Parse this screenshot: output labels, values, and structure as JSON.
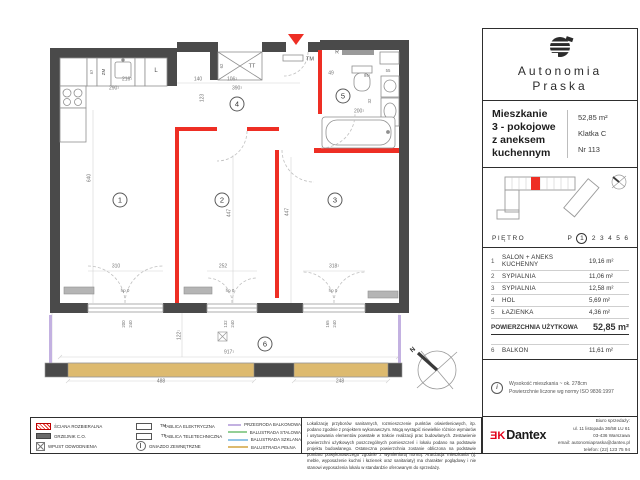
{
  "colors": {
    "wall": "#4a4a4a",
    "removable_wall_red": "#ee2e24",
    "balcony_partition_purple": "#c3b1e1",
    "balustrade_steel_green": "#93cf96",
    "balustrade_glass_blue": "#92c5e8",
    "balustrade_full_tan": "#ddba6f",
    "dantex_red": "#e2001a"
  },
  "panel": {
    "brand": {
      "name_line1": "Autonomia",
      "name_line2": "Praska"
    },
    "apartment": {
      "title_line1": "Mieszkanie",
      "title_line2": "3 - pokojowe",
      "title_line3": "z aneksem",
      "title_line4": "kuchennym",
      "area": "52,85 m²",
      "staircase": "Klatka C",
      "number": "Nr 113"
    },
    "floor_row": {
      "label": "PIĘTRO",
      "prefix": "P",
      "current": "1",
      "n2": "2",
      "n3": "3",
      "n4": "4",
      "n5": "5",
      "n6": "6"
    },
    "rooms": [
      {
        "num": "1",
        "name": "SALON + ANEKS KUCHENNY",
        "area": "19,16 m²"
      },
      {
        "num": "2",
        "name": "SYPIALNIA",
        "area": "11,06 m²"
      },
      {
        "num": "3",
        "name": "SYPIALNIA",
        "area": "12,58 m²"
      },
      {
        "num": "4",
        "name": "HOL",
        "area": "5,69 m²"
      },
      {
        "num": "5",
        "name": "ŁAZIENKA",
        "area": "4,36 m²"
      }
    ],
    "total": {
      "label": "POWIERZCHNIA UŻYTKOWA",
      "value": "52,85 m²"
    },
    "balcony_row": {
      "num": "6",
      "name": "BALKON",
      "area": "11,61 m²"
    },
    "note": {
      "icon": "i",
      "line1": "Wysokość mieszkania ~ ok. 278cm",
      "line2": "Powierzchnie liczone wg normy ISO 9836:1997"
    },
    "footer": {
      "logo_mark": "ƎK",
      "logo_text": "Dantex",
      "addr_line1": "Biuro sprzedaży:",
      "addr_line2": "ul. 11 listopada 36/58 LU 61",
      "addr_line3": "03-436 Warszawa",
      "addr_line4": "email: autonomiapraska@dantex.pl",
      "addr_line5": "telefon: (22) 123 75 94"
    }
  },
  "plan": {
    "rooms": {
      "r1": "1",
      "r2": "2",
      "r3": "3",
      "r4": "4",
      "r5": "5",
      "r6": "6"
    },
    "labels": {
      "tm": "TM",
      "tt": "TT",
      "zm": "ZM",
      "fridge": "L",
      "radiator_r": "R",
      "cab57": "57"
    },
    "dims": {
      "d216": "216¹",
      "d290": "290¹",
      "d140": "140",
      "d106": "106¹",
      "d390": "390¹",
      "d123": "123",
      "d640": "640",
      "d447a": "447",
      "d447b": "447",
      "d310": "310",
      "d252": "252",
      "d318": "318¹",
      "hp1": "hp 0",
      "hp2": "hp 0",
      "hp3": "hp 0",
      "d49": "49",
      "d94": "94¹",
      "d55": "55",
      "d200": "200¹",
      "d32": "32",
      "d62": "62",
      "b200": "200",
      "b240a": "240",
      "b132": "132",
      "b240b": "240",
      "b165": "165",
      "b240c": "240",
      "d122": "122¹",
      "d917": "917¹",
      "d488": "488",
      "d248": "248"
    },
    "compass_n": "N"
  },
  "legend": {
    "items": [
      {
        "label": "ŚCIANA ROZBIERALNA"
      },
      {
        "label": "GRZEJNIK C.O."
      },
      {
        "label": "WPUST ODWODNIENIA"
      },
      {
        "tag": "TM",
        "label": "TABLICA ELEKTRYCZNA"
      },
      {
        "tag": "TT",
        "label": "TABLICA TELETECHNICZNA"
      },
      {
        "label": "GNIAZDO ZEWNĘTRZNE"
      },
      {
        "color": "#c3b1e1",
        "label": "PRZEGRODA BALKONOWA"
      },
      {
        "color": "#93cf96",
        "label": "BALUSTRADA STALOWA"
      },
      {
        "color": "#92c5e8",
        "label": "BALUSTRADA SZKLANA"
      },
      {
        "color": "#ddba6f",
        "label": "BALUSTRADA PEŁNA"
      }
    ]
  },
  "disclaimer": "Lokalizację przyborów sanitarnych, rozmieszczenie punktów oświetleniowych, itp. podano zgodnie z projektem wykonawczym. Mogą wystąpić niewielkie różnice wymiarów i usytuowania elementów powstałe w trakcie realizacji prac budowlanych. Zestawienie powierzchni użytkowych poszczególnych pomieszczeń i lokalu podano na podstawie projektu budowlanego. Ostateczna powierzchnia zostanie obliczona na podstawie pomiaru powykonawczego zgodnie z wymienioną normą. Aranżacja mieszkania (tj. meble, wyposażenie kuchni i łazienek oraz sanitariaty) ma charakter poglądowy i nie stanowi wyposażenia lokalu w standardzie oferowanym do sprzedaży."
}
